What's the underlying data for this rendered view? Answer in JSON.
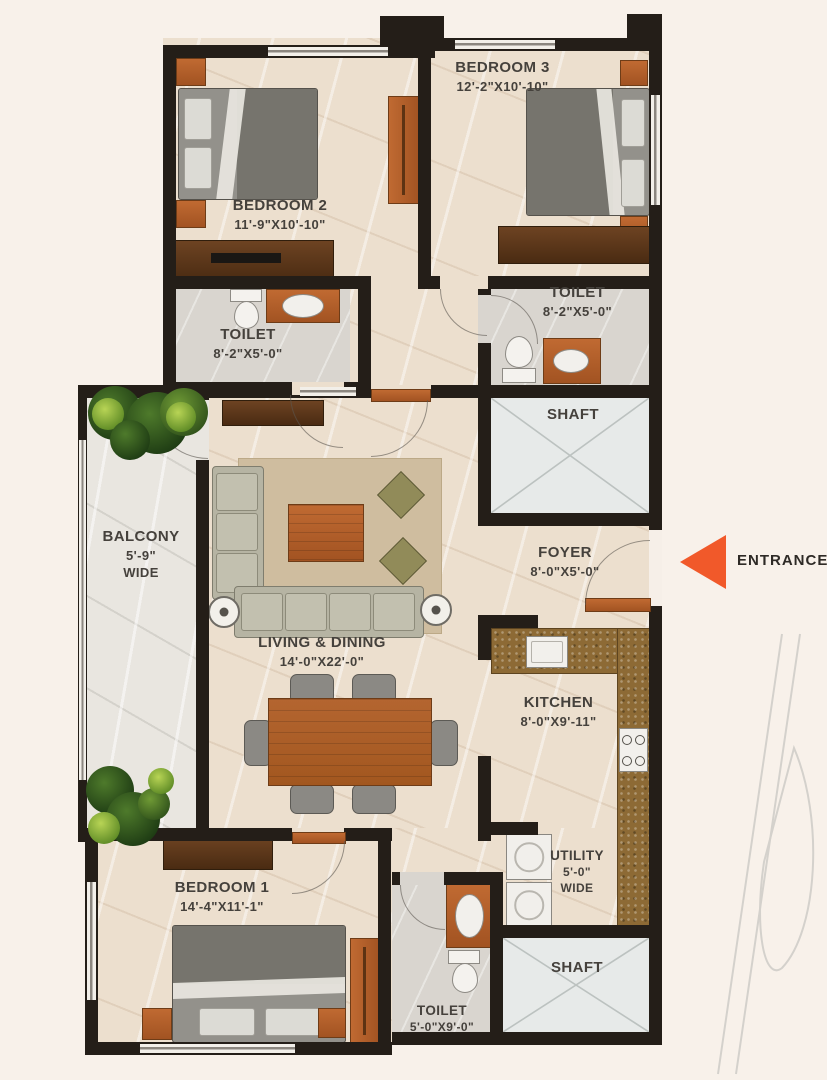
{
  "colors": {
    "wall": "#241E18",
    "floor_beige": "#ECDFCE",
    "balcony_floor": "#E9E6E0",
    "shaft_floor": "#E7EAE9",
    "door_wood": "#B5622F",
    "accent_orange": "#F1592A",
    "label_text": "#45413C"
  },
  "rooms": {
    "bedroom3": {
      "name": "BEDROOM 3",
      "dims": "12'-2\"X10'-10\""
    },
    "bedroom2": {
      "name": "BEDROOM 2",
      "dims": "11'-9\"X10'-10\""
    },
    "toilet2": {
      "name": "TOILET",
      "dims": "8'-2\"X5'-0\""
    },
    "toilet3": {
      "name": "TOILET",
      "dims": "8'-2\"X5'-0\""
    },
    "shaft_top": {
      "name": "SHAFT"
    },
    "balcony": {
      "name": "BALCONY",
      "dims": "5'-9\"",
      "wide": "WIDE"
    },
    "living": {
      "name": "LIVING & DINING",
      "dims": "14'-0\"X22'-0\""
    },
    "foyer": {
      "name": "FOYER",
      "dims": "8'-0\"X5'-0\""
    },
    "kitchen": {
      "name": "KITCHEN",
      "dims": "8'-0\"X9'-11\""
    },
    "utility": {
      "name": "UTILITY",
      "dims": "5'-0\"",
      "wide": "WIDE"
    },
    "bedroom1": {
      "name": "BEDROOM 1",
      "dims": "14'-4\"X11'-1\""
    },
    "toilet1": {
      "name": "TOILET",
      "dims": "5'-0\"X9'-0\""
    },
    "shaft_bottom": {
      "name": "SHAFT"
    }
  },
  "entrance": {
    "label": "ENTRANCE"
  }
}
